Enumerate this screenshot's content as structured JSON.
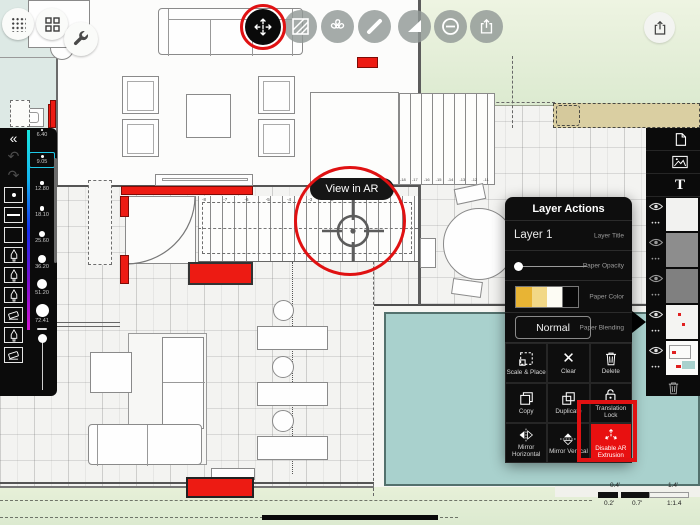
{
  "toolbar": {
    "icons": [
      "dots-grid",
      "apps-grid",
      "wrench",
      "ar-extrusion",
      "hatch-fill",
      "fan",
      "marker",
      "set-square",
      "subtract-circle",
      "share"
    ],
    "top_right_icon": "share"
  },
  "tooltip": {
    "label": "View in AR"
  },
  "left_toolbar": {
    "collapse": "«",
    "undo_glyph": "↶",
    "redo_glyph": "↷",
    "sizes": [
      "6.40",
      "9.05",
      "12.80",
      "18.10",
      "25.60",
      "36.20",
      "51.20",
      "72.41"
    ],
    "selected_size": "9.05"
  },
  "layer_actions": {
    "title": "Layer Actions",
    "layer_name": "Layer 1",
    "layer_title_label": "Layer Title",
    "opacity_label": "Paper Opacity",
    "color_label": "Paper Color",
    "blending_label": "Paper Blending",
    "blend_mode": "Normal",
    "actions": [
      "Scale & Place",
      "Clear",
      "Delete",
      "Copy",
      "Duplicate",
      "Translation Lock",
      "Mirror Horizontal",
      "Mirror Vertical",
      "Disable AR Extrusion"
    ],
    "clear_glyph": "✕"
  },
  "layers_panel": {
    "text_tool_label": "T",
    "dots_glyph": "•••"
  },
  "stairs": {
    "main_labels": "-8 -7 -6 -5 -4 -3 -2 -1",
    "upper_labels": "-18 -17 -16 -15 -14 -13 -12 -11 -10"
  },
  "scale_bar": {
    "top_left": "0.4'",
    "top_right": "1.4'",
    "bottom_left": "0.2'",
    "bottom_mid": "0.7'",
    "ratio": "1:1.4"
  },
  "colors": {
    "accent_red": "#ed1b13",
    "annotation_red": "#e01112",
    "pool_teal": "#a9d1cd",
    "lawn_green": "#e4eed4",
    "deck_khaki": "#dacfa2",
    "selection_cyan": "#1ec9e8"
  }
}
